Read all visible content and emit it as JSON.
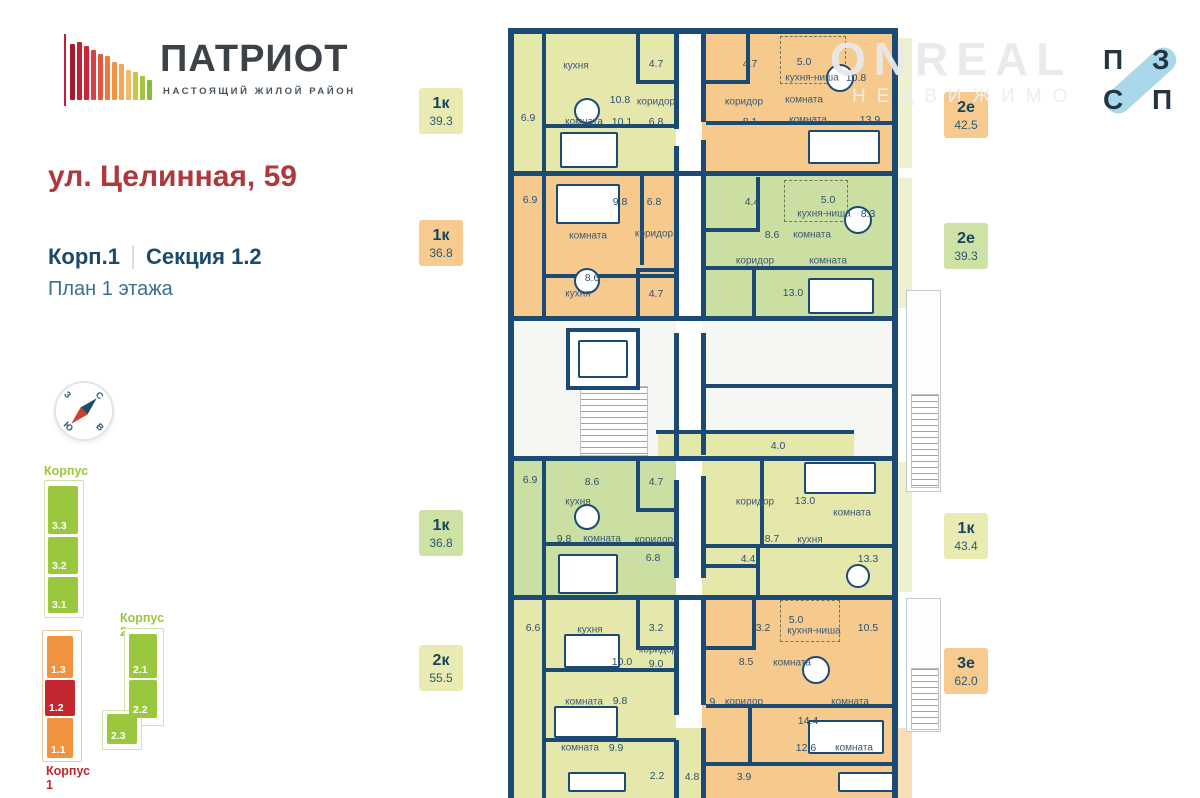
{
  "header": {
    "logo_title": "ПАТРИОТ",
    "logo_subtitle": "НАСТОЯЩИЙ ЖИЛОЙ РАЙОН",
    "address": "ул. Целинная, 59",
    "building": "Корп.1",
    "section": "Секция 1.2",
    "floor": "План 1 этажа"
  },
  "logo_bars": [
    {
      "h": 56,
      "c": "#9f1c2e"
    },
    {
      "h": 58,
      "c": "#c31f36"
    },
    {
      "h": 54,
      "c": "#cf2438"
    },
    {
      "h": 50,
      "c": "#d84043"
    },
    {
      "h": 46,
      "c": "#e2563d"
    },
    {
      "h": 44,
      "c": "#ec7a3b"
    },
    {
      "h": 38,
      "c": "#f2923f"
    },
    {
      "h": 36,
      "c": "#f5a654"
    },
    {
      "h": 30,
      "c": "#f2b968"
    },
    {
      "h": 28,
      "c": "#c8c83e"
    },
    {
      "h": 24,
      "c": "#a3c43c"
    },
    {
      "h": 20,
      "c": "#86bb3e"
    }
  ],
  "compass": {
    "n": "С",
    "e": "В",
    "s": "Ю",
    "w": "З"
  },
  "site_map": {
    "labels": [
      {
        "t": "Корпус 3",
        "x": 44,
        "y": 464,
        "cls": "t-grn"
      },
      {
        "t": "Корпус 2",
        "x": 120,
        "y": 611,
        "cls": "t-grn"
      },
      {
        "t": "Корпус 1",
        "x": 46,
        "y": 764,
        "cls": "t-red"
      }
    ],
    "outlines": [
      {
        "x": 44,
        "y": 480,
        "w": 38,
        "h": 136,
        "cls": ""
      },
      {
        "x": 124,
        "y": 628,
        "w": 38,
        "h": 96,
        "cls": ""
      },
      {
        "x": 102,
        "y": 710,
        "w": 38,
        "h": 38,
        "cls": ""
      },
      {
        "x": 42,
        "y": 630,
        "w": 38,
        "h": 130,
        "cls": "o-org"
      }
    ],
    "blocks": [
      {
        "t": "3.3",
        "x": 48,
        "y": 486,
        "w": 30,
        "h": 48,
        "c": "b-grn"
      },
      {
        "t": "3.2",
        "x": 48,
        "y": 537,
        "w": 30,
        "h": 37,
        "c": "b-grn"
      },
      {
        "t": "3.1",
        "x": 48,
        "y": 577,
        "w": 30,
        "h": 36,
        "c": "b-grn"
      },
      {
        "t": "2.1",
        "x": 129,
        "y": 634,
        "w": 28,
        "h": 44,
        "c": "b-grn"
      },
      {
        "t": "2.2",
        "x": 129,
        "y": 680,
        "w": 28,
        "h": 38,
        "c": "b-grn"
      },
      {
        "t": "2.3",
        "x": 107,
        "y": 714,
        "w": 30,
        "h": 30,
        "c": "b-grn"
      },
      {
        "t": "1.3",
        "x": 47,
        "y": 636,
        "w": 26,
        "h": 42,
        "c": "b-org"
      },
      {
        "t": "1.2",
        "x": 45,
        "y": 680,
        "w": 30,
        "h": 36,
        "c": "b-red"
      },
      {
        "t": "1.1",
        "x": 47,
        "y": 718,
        "w": 26,
        "h": 40,
        "c": "b-org"
      }
    ]
  },
  "badges": [
    {
      "x": 419,
      "y": 88,
      "t": "1к",
      "a": "39.3",
      "c": "bg-pale"
    },
    {
      "x": 419,
      "y": 220,
      "t": "1к",
      "a": "36.8",
      "c": "bg-org"
    },
    {
      "x": 419,
      "y": 510,
      "t": "1к",
      "a": "36.8",
      "c": "bg-grn"
    },
    {
      "x": 419,
      "y": 645,
      "t": "2к",
      "a": "55.5",
      "c": "bg-pale"
    },
    {
      "x": 944,
      "y": 92,
      "t": "2е",
      "a": "42.5",
      "c": "bg-org"
    },
    {
      "x": 944,
      "y": 223,
      "t": "2е",
      "a": "39.3",
      "c": "bg-grn"
    },
    {
      "x": 944,
      "y": 513,
      "t": "1к",
      "a": "43.4",
      "c": "bg-pale"
    },
    {
      "x": 944,
      "y": 648,
      "t": "3е",
      "a": "62.0",
      "c": "bg-org"
    }
  ],
  "watermark": {
    "line1": "ONREAL",
    "line2": "НЕДВИЖИМО"
  },
  "pzsp": {
    "letters": [
      {
        "t": "П",
        "x": 1103,
        "y": 46
      },
      {
        "t": "З",
        "x": 1152,
        "y": 46
      },
      {
        "t": "С",
        "x": 1103,
        "y": 86
      },
      {
        "t": "П",
        "x": 1152,
        "y": 86
      }
    ]
  },
  "plan": {
    "regions": [
      {
        "x": 6,
        "y": 6,
        "w": 162,
        "h": 139,
        "c": "pale"
      },
      {
        "x": 194,
        "y": 6,
        "w": 190,
        "h": 139,
        "c": "org"
      },
      {
        "x": 6,
        "y": 147,
        "w": 162,
        "h": 143,
        "c": "org"
      },
      {
        "x": 194,
        "y": 147,
        "w": 190,
        "h": 143,
        "c": "grn"
      },
      {
        "x": 6,
        "y": 292,
        "w": 162,
        "h": 138,
        "c": "white"
      },
      {
        "x": 194,
        "y": 292,
        "w": 190,
        "h": 138,
        "c": "white"
      },
      {
        "x": 150,
        "y": 405,
        "w": 196,
        "h": 27,
        "c": "pale"
      },
      {
        "x": 6,
        "y": 432,
        "w": 162,
        "h": 138,
        "c": "grn"
      },
      {
        "x": 194,
        "y": 432,
        "w": 190,
        "h": 138,
        "c": "pale"
      },
      {
        "x": 6,
        "y": 570,
        "w": 162,
        "h": 200,
        "c": "pale"
      },
      {
        "x": 194,
        "y": 570,
        "w": 190,
        "h": 200,
        "c": "org"
      },
      {
        "x": 168,
        "y": 700,
        "w": 30,
        "h": 70,
        "c": "pale"
      },
      {
        "x": 390,
        "y": 10,
        "w": 14,
        "h": 130,
        "c": "strip-pale"
      },
      {
        "x": 390,
        "y": 150,
        "w": 14,
        "h": 130,
        "c": "strip-pale"
      },
      {
        "x": 390,
        "y": 434,
        "w": 14,
        "h": 130,
        "c": "strip-pale"
      },
      {
        "x": 390,
        "y": 700,
        "w": 14,
        "h": 70,
        "c": "strip-org"
      }
    ],
    "walls": [
      {
        "x": 0,
        "y": 0,
        "w": 390,
        "h": 6
      },
      {
        "x": 0,
        "y": 0,
        "w": 6,
        "h": 770
      },
      {
        "x": 384,
        "y": 0,
        "w": 6,
        "h": 770
      },
      {
        "x": 0,
        "y": 143,
        "w": 390,
        "h": 5
      },
      {
        "x": 0,
        "y": 288,
        "w": 390,
        "h": 5
      },
      {
        "x": 0,
        "y": 428,
        "w": 390,
        "h": 5
      },
      {
        "x": 0,
        "y": 567,
        "w": 390,
        "h": 5
      },
      {
        "x": 166,
        "y": 6,
        "w": 5,
        "h": 95
      },
      {
        "x": 166,
        "y": 118,
        "w": 5,
        "h": 172
      },
      {
        "x": 166,
        "y": 305,
        "w": 5,
        "h": 125
      },
      {
        "x": 166,
        "y": 452,
        "w": 5,
        "h": 98
      },
      {
        "x": 166,
        "y": 567,
        "w": 5,
        "h": 120
      },
      {
        "x": 166,
        "y": 712,
        "w": 5,
        "h": 58
      },
      {
        "x": 193,
        "y": 6,
        "w": 5,
        "h": 88
      },
      {
        "x": 193,
        "y": 112,
        "w": 5,
        "h": 178
      },
      {
        "x": 193,
        "y": 305,
        "w": 5,
        "h": 122
      },
      {
        "x": 193,
        "y": 448,
        "w": 5,
        "h": 102
      },
      {
        "x": 193,
        "y": 567,
        "w": 5,
        "h": 110
      },
      {
        "x": 193,
        "y": 700,
        "w": 5,
        "h": 70
      },
      {
        "x": 34,
        "y": 6,
        "w": 4,
        "h": 139
      },
      {
        "x": 34,
        "y": 147,
        "w": 4,
        "h": 143
      },
      {
        "x": 34,
        "y": 432,
        "w": 4,
        "h": 138
      },
      {
        "x": 34,
        "y": 570,
        "w": 4,
        "h": 200
      },
      {
        "x": 128,
        "y": 6,
        "w": 4,
        "h": 50
      },
      {
        "x": 128,
        "y": 52,
        "w": 42,
        "h": 4
      },
      {
        "x": 38,
        "y": 96,
        "w": 130,
        "h": 4
      },
      {
        "x": 238,
        "y": 6,
        "w": 4,
        "h": 50
      },
      {
        "x": 196,
        "y": 52,
        "w": 46,
        "h": 4
      },
      {
        "x": 198,
        "y": 93,
        "w": 186,
        "h": 4
      },
      {
        "x": 132,
        "y": 147,
        "w": 4,
        "h": 90
      },
      {
        "x": 38,
        "y": 246,
        "w": 130,
        "h": 4
      },
      {
        "x": 128,
        "y": 240,
        "w": 42,
        "h": 4
      },
      {
        "x": 128,
        "y": 240,
        "w": 4,
        "h": 50
      },
      {
        "x": 248,
        "y": 149,
        "w": 4,
        "h": 52
      },
      {
        "x": 196,
        "y": 200,
        "w": 56,
        "h": 4
      },
      {
        "x": 198,
        "y": 238,
        "w": 186,
        "h": 4
      },
      {
        "x": 244,
        "y": 242,
        "w": 4,
        "h": 46
      },
      {
        "x": 148,
        "y": 402,
        "w": 198,
        "h": 4
      },
      {
        "x": 196,
        "y": 356,
        "w": 190,
        "h": 4
      },
      {
        "x": 128,
        "y": 432,
        "w": 4,
        "h": 50
      },
      {
        "x": 128,
        "y": 480,
        "w": 42,
        "h": 4
      },
      {
        "x": 38,
        "y": 514,
        "w": 130,
        "h": 4
      },
      {
        "x": 252,
        "y": 432,
        "w": 4,
        "h": 88
      },
      {
        "x": 198,
        "y": 516,
        "w": 186,
        "h": 4
      },
      {
        "x": 248,
        "y": 520,
        "w": 4,
        "h": 50
      },
      {
        "x": 196,
        "y": 536,
        "w": 54,
        "h": 4
      },
      {
        "x": 128,
        "y": 570,
        "w": 4,
        "h": 50
      },
      {
        "x": 128,
        "y": 618,
        "w": 42,
        "h": 4
      },
      {
        "x": 38,
        "y": 640,
        "w": 130,
        "h": 4
      },
      {
        "x": 38,
        "y": 710,
        "w": 130,
        "h": 4
      },
      {
        "x": 244,
        "y": 570,
        "w": 4,
        "h": 50
      },
      {
        "x": 196,
        "y": 618,
        "w": 52,
        "h": 4
      },
      {
        "x": 198,
        "y": 676,
        "w": 186,
        "h": 4
      },
      {
        "x": 198,
        "y": 734,
        "w": 186,
        "h": 4
      },
      {
        "x": 240,
        "y": 680,
        "w": 4,
        "h": 56
      }
    ],
    "dashes": [
      {
        "x": 272,
        "y": 8,
        "w": 64,
        "h": 46
      },
      {
        "x": 276,
        "y": 152,
        "w": 62,
        "h": 40
      },
      {
        "x": 272,
        "y": 572,
        "w": 58,
        "h": 40
      }
    ],
    "porches": [
      {
        "x": 398,
        "y": 262,
        "w": 33,
        "h": 200
      },
      {
        "x": 398,
        "y": 570,
        "w": 33,
        "h": 132
      }
    ],
    "hatches": [
      {
        "x": 72,
        "y": 358,
        "w": 66,
        "h": 68
      },
      {
        "x": 403,
        "y": 366,
        "w": 26,
        "h": 92
      },
      {
        "x": 403,
        "y": 640,
        "w": 26,
        "h": 60
      }
    ],
    "furniture": [
      {
        "t": "lift",
        "x": 58,
        "y": 300,
        "w": 74,
        "h": 62
      },
      {
        "t": "r",
        "x": 70,
        "y": 312,
        "w": 50,
        "h": 38
      },
      {
        "t": "c",
        "x": 66,
        "y": 70,
        "d": 26
      },
      {
        "t": "c",
        "x": 318,
        "y": 36,
        "d": 28
      },
      {
        "t": "c",
        "x": 66,
        "y": 240,
        "d": 26
      },
      {
        "t": "c",
        "x": 336,
        "y": 178,
        "d": 28
      },
      {
        "t": "c",
        "x": 66,
        "y": 476,
        "d": 26
      },
      {
        "t": "c",
        "x": 338,
        "y": 536,
        "d": 24
      },
      {
        "t": "c",
        "x": 294,
        "y": 628,
        "d": 28
      },
      {
        "t": "r",
        "x": 52,
        "y": 104,
        "w": 58,
        "h": 36
      },
      {
        "t": "r",
        "x": 300,
        "y": 102,
        "w": 72,
        "h": 34
      },
      {
        "t": "r",
        "x": 48,
        "y": 156,
        "w": 64,
        "h": 40
      },
      {
        "t": "r",
        "x": 300,
        "y": 250,
        "w": 66,
        "h": 36
      },
      {
        "t": "r",
        "x": 50,
        "y": 526,
        "w": 60,
        "h": 40
      },
      {
        "t": "r",
        "x": 296,
        "y": 434,
        "w": 72,
        "h": 32
      },
      {
        "t": "r",
        "x": 56,
        "y": 606,
        "w": 56,
        "h": 34
      },
      {
        "t": "r",
        "x": 46,
        "y": 678,
        "w": 64,
        "h": 32
      },
      {
        "t": "r",
        "x": 60,
        "y": 744,
        "w": 58,
        "h": 20
      },
      {
        "t": "r",
        "x": 300,
        "y": 692,
        "w": 76,
        "h": 34
      },
      {
        "t": "r",
        "x": 330,
        "y": 744,
        "w": 56,
        "h": 20
      }
    ],
    "labels": [
      {
        "t": "6.9",
        "x": 20,
        "y": 90
      },
      {
        "t": "кухня",
        "x": 68,
        "y": 38
      },
      {
        "t": "10.8",
        "x": 112,
        "y": 72
      },
      {
        "t": "комната",
        "x": 76,
        "y": 94
      },
      {
        "t": "10.1",
        "x": 114,
        "y": 94
      },
      {
        "t": "4.7",
        "x": 148,
        "y": 36
      },
      {
        "t": "коридор",
        "x": 148,
        "y": 74
      },
      {
        "t": "6.8",
        "x": 148,
        "y": 94
      },
      {
        "t": "4.7",
        "x": 242,
        "y": 36
      },
      {
        "t": "коридор",
        "x": 236,
        "y": 74
      },
      {
        "t": "8.1",
        "x": 242,
        "y": 94
      },
      {
        "t": "5.0",
        "x": 296,
        "y": 34
      },
      {
        "t": "кухня-ниша",
        "x": 304,
        "y": 50
      },
      {
        "t": "10.8",
        "x": 348,
        "y": 50
      },
      {
        "t": "комната",
        "x": 296,
        "y": 72
      },
      {
        "t": "комната",
        "x": 300,
        "y": 92
      },
      {
        "t": "13.9",
        "x": 362,
        "y": 92
      },
      {
        "t": "6.9",
        "x": 22,
        "y": 172
      },
      {
        "t": "9.8",
        "x": 112,
        "y": 174
      },
      {
        "t": "6.8",
        "x": 146,
        "y": 174
      },
      {
        "t": "комната",
        "x": 80,
        "y": 208
      },
      {
        "t": "коридор",
        "x": 146,
        "y": 206
      },
      {
        "t": "8.6",
        "x": 84,
        "y": 250
      },
      {
        "t": "кухня",
        "x": 70,
        "y": 266
      },
      {
        "t": "4.7",
        "x": 148,
        "y": 266
      },
      {
        "t": "4.4",
        "x": 244,
        "y": 174
      },
      {
        "t": "5.0",
        "x": 320,
        "y": 172
      },
      {
        "t": "кухня-ниша",
        "x": 316,
        "y": 186
      },
      {
        "t": "8.3",
        "x": 360,
        "y": 186
      },
      {
        "t": "8.6",
        "x": 264,
        "y": 207
      },
      {
        "t": "комната",
        "x": 304,
        "y": 207
      },
      {
        "t": "коридор",
        "x": 247,
        "y": 233
      },
      {
        "t": "комната",
        "x": 320,
        "y": 233
      },
      {
        "t": "13.0",
        "x": 285,
        "y": 265
      },
      {
        "t": "4.0",
        "x": 270,
        "y": 418
      },
      {
        "t": "6.9",
        "x": 22,
        "y": 452
      },
      {
        "t": "8.6",
        "x": 84,
        "y": 454
      },
      {
        "t": "4.7",
        "x": 148,
        "y": 454
      },
      {
        "t": "кухня",
        "x": 70,
        "y": 474
      },
      {
        "t": "9.8",
        "x": 56,
        "y": 511
      },
      {
        "t": "комната",
        "x": 94,
        "y": 511
      },
      {
        "t": "коридор",
        "x": 146,
        "y": 512
      },
      {
        "t": "6.8",
        "x": 145,
        "y": 530
      },
      {
        "t": "коридор",
        "x": 247,
        "y": 474
      },
      {
        "t": "13.0",
        "x": 297,
        "y": 473
      },
      {
        "t": "комната",
        "x": 344,
        "y": 485
      },
      {
        "t": "8.7",
        "x": 264,
        "y": 511
      },
      {
        "t": "кухня",
        "x": 302,
        "y": 512
      },
      {
        "t": "4.4",
        "x": 240,
        "y": 531
      },
      {
        "t": "13.3",
        "x": 360,
        "y": 531
      },
      {
        "t": "6.6",
        "x": 25,
        "y": 600
      },
      {
        "t": "кухня",
        "x": 82,
        "y": 602
      },
      {
        "t": "3.2",
        "x": 148,
        "y": 600
      },
      {
        "t": "10.0",
        "x": 114,
        "y": 634
      },
      {
        "t": "коридор",
        "x": 150,
        "y": 622
      },
      {
        "t": "9.0",
        "x": 148,
        "y": 636
      },
      {
        "t": "комната",
        "x": 76,
        "y": 674
      },
      {
        "t": "9.8",
        "x": 112,
        "y": 673
      },
      {
        "t": "комната",
        "x": 72,
        "y": 720
      },
      {
        "t": "9.9",
        "x": 108,
        "y": 720
      },
      {
        "t": "2.2",
        "x": 149,
        "y": 748
      },
      {
        "t": "4.8",
        "x": 184,
        "y": 749
      },
      {
        "t": "3.2",
        "x": 255,
        "y": 600
      },
      {
        "t": "5.0",
        "x": 288,
        "y": 592
      },
      {
        "t": "кухня-ниша",
        "x": 306,
        "y": 603
      },
      {
        "t": "10.5",
        "x": 360,
        "y": 600
      },
      {
        "t": "8.5",
        "x": 238,
        "y": 634
      },
      {
        "t": "комната",
        "x": 284,
        "y": 635
      },
      {
        "t": "3.9",
        "x": 200,
        "y": 674
      },
      {
        "t": "коридор",
        "x": 236,
        "y": 674
      },
      {
        "t": "комната",
        "x": 342,
        "y": 674
      },
      {
        "t": "14.4",
        "x": 300,
        "y": 693
      },
      {
        "t": "12.6",
        "x": 298,
        "y": 720
      },
      {
        "t": "комната",
        "x": 346,
        "y": 720
      },
      {
        "t": "3.9",
        "x": 236,
        "y": 749
      }
    ]
  }
}
